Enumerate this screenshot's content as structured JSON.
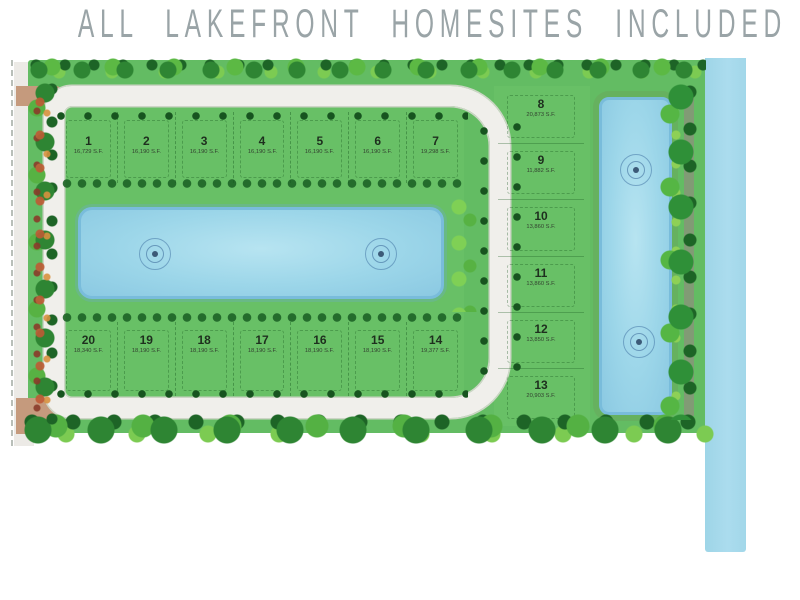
{
  "title": "ALL LAKEFRONT HOMESITES INCLUDED",
  "lots": {
    "top_row": [
      {
        "number": "1",
        "area": "16,729 S.F."
      },
      {
        "number": "2",
        "area": "16,190 S.F."
      },
      {
        "number": "3",
        "area": "16,190 S.F."
      },
      {
        "number": "4",
        "area": "16,190 S.F."
      },
      {
        "number": "5",
        "area": "16,190 S.F."
      },
      {
        "number": "6",
        "area": "16,190 S.F."
      },
      {
        "number": "7",
        "area": "19,298 S.F."
      }
    ],
    "right_column": [
      {
        "number": "8",
        "area": "20,873 S.F."
      },
      {
        "number": "9",
        "area": "11,882 S.F."
      },
      {
        "number": "10",
        "area": "13,860 S.F."
      },
      {
        "number": "11",
        "area": "13,860 S.F."
      },
      {
        "number": "12",
        "area": "13,850 S.F."
      },
      {
        "number": "13",
        "area": "20,903 S.F."
      }
    ],
    "bottom_row": [
      {
        "number": "20",
        "area": "18,340 S.F."
      },
      {
        "number": "19",
        "area": "18,190 S.F."
      },
      {
        "number": "18",
        "area": "18,190 S.F."
      },
      {
        "number": "17",
        "area": "18,190 S.F."
      },
      {
        "number": "16",
        "area": "18,190 S.F."
      },
      {
        "number": "15",
        "area": "18,190 S.F."
      },
      {
        "number": "14",
        "area": "19,377 S.F."
      }
    ]
  },
  "features": {
    "central_lake": "lake",
    "right_lake": "lake",
    "fountain_icon": "fountain",
    "canal": "waterway"
  },
  "colors": {
    "land_green": "#63bc63",
    "road_white": "#f0efeb",
    "perimeter_tan": "#c59a7d",
    "water_blue": "#9cd6e9",
    "canal_blue": "#a5d9e9",
    "tree_dark": "#1d6426",
    "tree_mid": "#2e8533",
    "tree_light": "#5cb944",
    "shrub_red": "#bf5a35",
    "title_gray": "#9aa4a7"
  }
}
